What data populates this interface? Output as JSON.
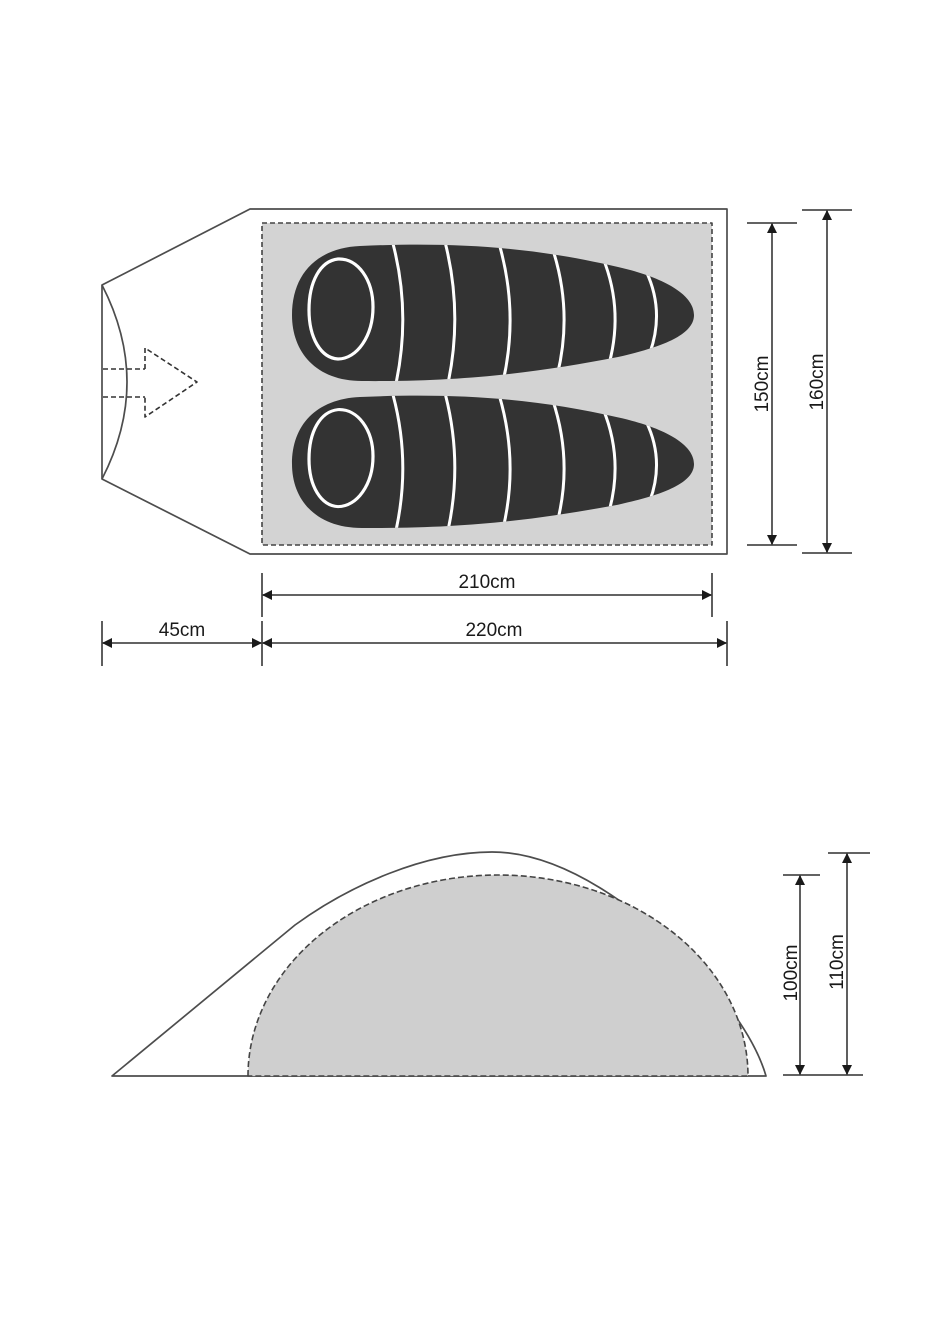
{
  "colors": {
    "background": "#ffffff",
    "floor_fill": "#d3d3d3",
    "dome_fill": "#cfcfcf",
    "bag_fill": "#333333",
    "outline_stroke": "#4d4d4d",
    "dimension_stroke": "#4d4d4d",
    "arrow_fill": "#1a1a1a",
    "stripe_color": "#ffffff"
  },
  "top_view": {
    "dims": {
      "floor_width": "150cm",
      "outer_width": "160cm",
      "floor_length": "210cm",
      "outer_length": "220cm",
      "vestibule_depth": "45cm"
    }
  },
  "side_view": {
    "dims": {
      "inner_height": "100cm",
      "outer_height": "110cm"
    }
  }
}
